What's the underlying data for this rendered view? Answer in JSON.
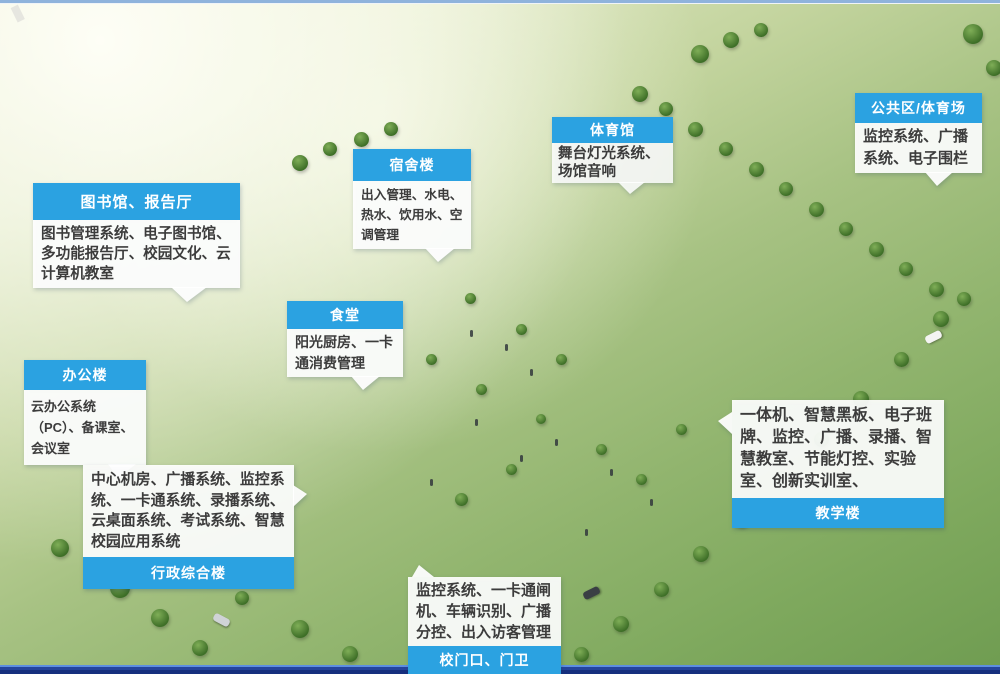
{
  "colors": {
    "header_blue": "#2BA2E1",
    "panel_white": "rgba(255,255,255,0.92)",
    "bottom_bar_blue": "#162F7E",
    "track_orange": "#C0562C",
    "field_green": "#55A23A"
  },
  "callouts": {
    "library": {
      "title": "图书馆、报告厅",
      "body": "图书管理系统、电子图书馆、多功能报告厅、校园文化、云计算机教室"
    },
    "dorm": {
      "title": "宿舍楼",
      "body": "出入管理、水电、热水、饮用水、空调管理"
    },
    "gym": {
      "title": "体育馆",
      "body": "舞台灯光系统、场馆音响"
    },
    "public_area": {
      "title": "公共区/体育场",
      "body": "监控系统、广播系统、电子围栏"
    },
    "canteen": {
      "title": "食堂",
      "body": "阳光厨房、一卡通消费管理"
    },
    "office": {
      "title": "办公楼",
      "body": "云办公系统（PC）、备课室、会议室"
    },
    "admin": {
      "title": "行政综合楼",
      "body": "中心机房、广播系统、监控系统、一卡通系统、录播系统、云桌面系统、考试系统、智慧校园应用系统"
    },
    "teaching": {
      "title": "教学楼",
      "body": "一体机、智慧黑板、电子班牌、监控、广播、录播、智慧教室、节能灯控、实验室、创新实训室、"
    },
    "gate": {
      "title": "校门口、门卫",
      "body": "监控系统、一卡通闸机、车辆识别、广播分控、出入访客管理"
    }
  }
}
